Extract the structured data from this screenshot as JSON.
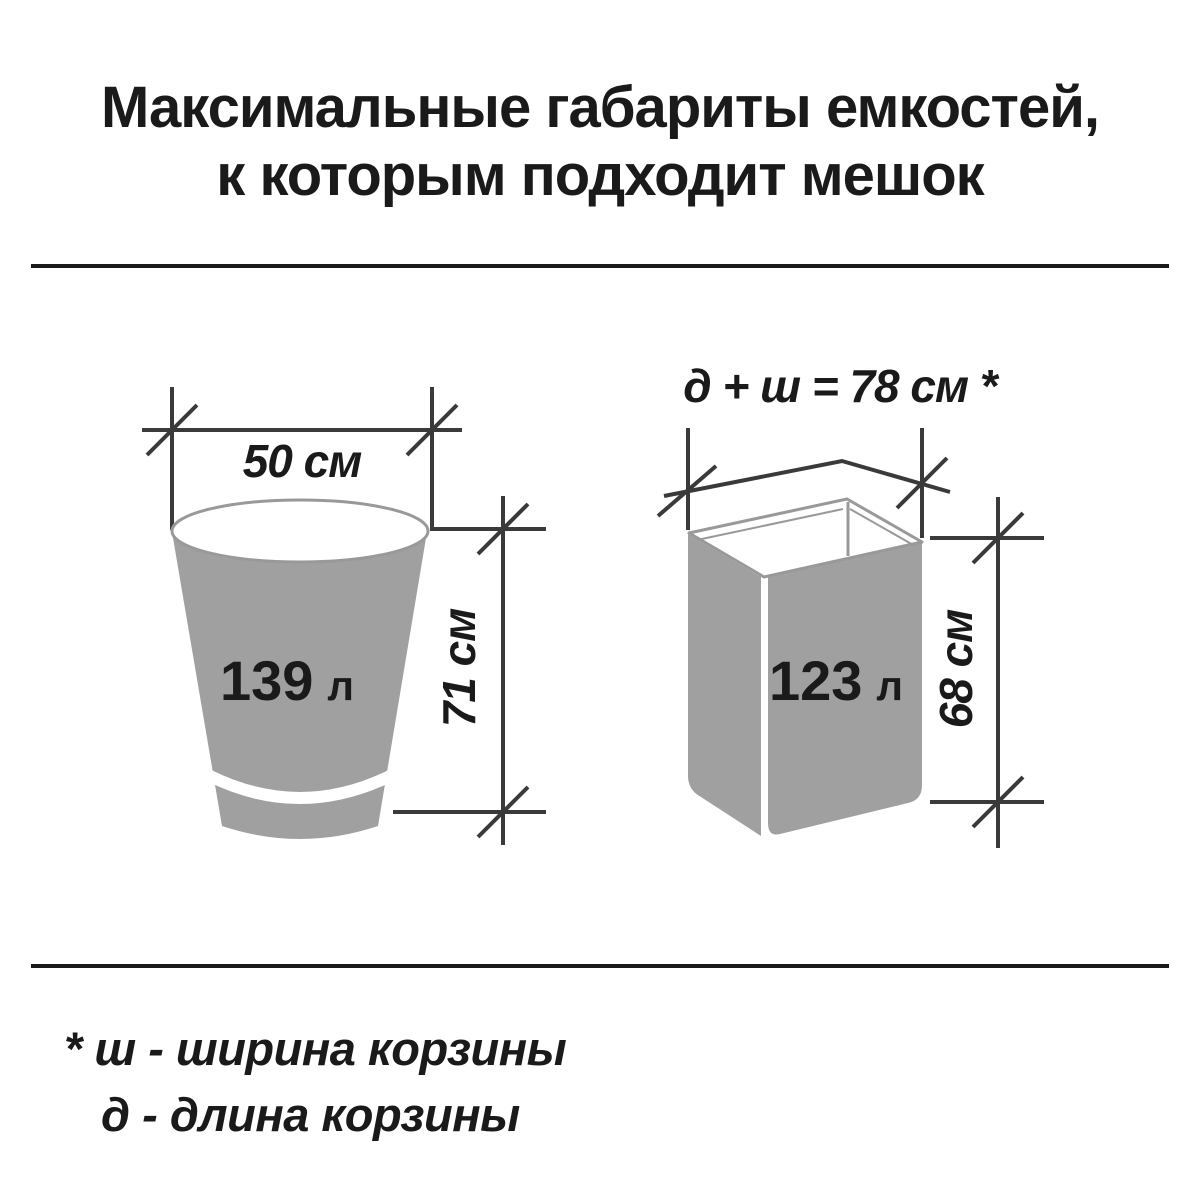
{
  "title": {
    "line1": "Максимальные габариты емкостей,",
    "line2": "к которым подходит мешок"
  },
  "bucket": {
    "diameter_label": "50 см",
    "volume_value": "139",
    "volume_unit": "л",
    "height_label": "71 см"
  },
  "basket": {
    "top_dimension_label": "д + ш = 78 см *",
    "volume_value": "123",
    "volume_unit": "л",
    "height_label": "68 см"
  },
  "footnote": {
    "line1": "* ш - ширина корзины",
    "line2": "д - длина корзины"
  },
  "colors": {
    "background": "#ffffff",
    "container_fill": "#a0a0a0",
    "container_outline": "#999999",
    "dimension_lines": "#3a3a3a",
    "text": "#1a1a1a"
  }
}
